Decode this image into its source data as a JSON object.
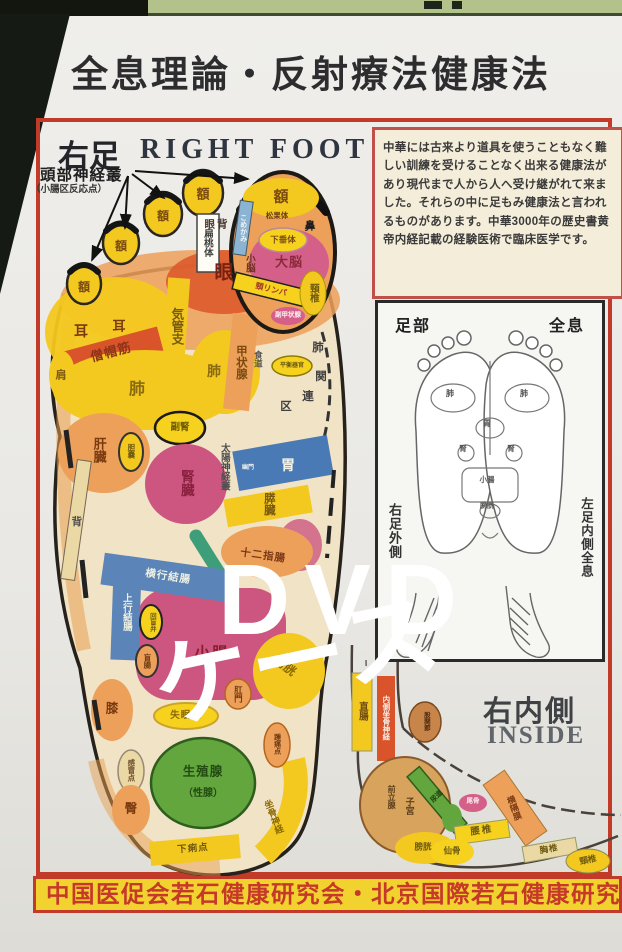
{
  "header": {
    "title": "全息理論・反射療法健康法"
  },
  "overlay": {
    "line1": "DVD",
    "line2": "ケース"
  },
  "foot_chart": {
    "title_jp": "右足",
    "title_en": "RIGHT FOOT",
    "annotation": "頭部神経叢",
    "annotation_sub": "（小腸区反応点）",
    "labels": [
      {
        "t": "額",
        "x": 84,
        "y": 287,
        "s": 12,
        "c": "#7a4a10"
      },
      {
        "t": "額",
        "x": 121,
        "y": 246,
        "s": 12,
        "c": "#7a4a10"
      },
      {
        "t": "額",
        "x": 163,
        "y": 216,
        "s": 12,
        "c": "#7a4a10"
      },
      {
        "t": "額",
        "x": 203,
        "y": 194,
        "s": 13,
        "c": "#7a4a10"
      },
      {
        "t": "額",
        "x": 281,
        "y": 197,
        "s": 15,
        "c": "#7a4a10"
      },
      {
        "t": "扁桃体",
        "x": 207,
        "y": 243,
        "s": 9.5,
        "c": "#3f3f3f",
        "v": 1
      },
      {
        "t": "眼背",
        "x": 217,
        "y": 225,
        "s": 10.5,
        "c": "#4a3a32",
        "ls": 2
      },
      {
        "t": "こめかみ",
        "x": 243,
        "y": 228,
        "s": 7,
        "c": "#f4f6f8",
        "v": 1
      },
      {
        "t": "松果体",
        "x": 277,
        "y": 216,
        "s": 7.5,
        "c": "#6b3a1a"
      },
      {
        "t": "下垂体",
        "x": 283,
        "y": 240,
        "s": 8.5,
        "c": "#7a4a10"
      },
      {
        "t": "大脳",
        "x": 289,
        "y": 262,
        "s": 13,
        "c": "#8a2a3a",
        "ls": 1
      },
      {
        "t": "小脳",
        "x": 249,
        "y": 263,
        "s": 9.5,
        "c": "#6e3020",
        "v": 1
      },
      {
        "t": "鼻",
        "x": 310,
        "y": 227,
        "s": 11,
        "c": "#1e1e1e"
      },
      {
        "t": "頸リンパ",
        "x": 271,
        "y": 290,
        "s": 8,
        "c": "#a03828",
        "r": 14
      },
      {
        "t": "頸椎",
        "x": 313,
        "y": 293,
        "s": 9.5,
        "c": "#6e5a10",
        "v": 1
      },
      {
        "t": "副甲状腺",
        "x": 288,
        "y": 316,
        "s": 6.5,
        "c": "#fdf2f2"
      },
      {
        "t": "眼",
        "x": 224,
        "y": 273,
        "s": 19,
        "c": "#7a2010"
      },
      {
        "t": "耳",
        "x": 81,
        "y": 331,
        "s": 14,
        "c": "#7a3a10"
      },
      {
        "t": "耳",
        "x": 119,
        "y": 326,
        "s": 13,
        "c": "#7a3a10"
      },
      {
        "t": "僧帽筋",
        "x": 111,
        "y": 352,
        "s": 13,
        "c": "#8f3418",
        "r": -15,
        "ls": 1
      },
      {
        "t": "気管支",
        "x": 176,
        "y": 326,
        "s": 12.5,
        "c": "#7a5a10",
        "v": 1
      },
      {
        "t": "肺",
        "x": 137,
        "y": 390,
        "s": 16,
        "c": "#8a6a10"
      },
      {
        "t": "肺",
        "x": 214,
        "y": 371,
        "s": 14,
        "c": "#8a6a10"
      },
      {
        "t": "甲状腺",
        "x": 240,
        "y": 362,
        "s": 11.5,
        "c": "#7a4a10",
        "v": 1
      },
      {
        "t": "食道",
        "x": 258,
        "y": 359,
        "s": 8.5,
        "c": "#555555",
        "v": 1
      },
      {
        "t": "平衡器官",
        "x": 292,
        "y": 366,
        "s": 6,
        "c": "#6e5a10"
      },
      {
        "t": "肺",
        "x": 318,
        "y": 349,
        "s": 11.5,
        "c": "#3f3f3f"
      },
      {
        "t": "関",
        "x": 321,
        "y": 378,
        "s": 11.5,
        "c": "#3f3f3f"
      },
      {
        "t": "連",
        "x": 308,
        "y": 398,
        "s": 11.5,
        "c": "#3f3f3f"
      },
      {
        "t": "区",
        "x": 286,
        "y": 408,
        "s": 11.5,
        "c": "#3f3f3f"
      },
      {
        "t": "肩",
        "x": 61,
        "y": 376,
        "s": 11,
        "c": "#7a5a10"
      },
      {
        "t": "肝臓",
        "x": 99,
        "y": 450,
        "s": 13,
        "c": "#7a3a10",
        "v": 1
      },
      {
        "t": "胆嚢",
        "x": 131,
        "y": 451,
        "s": 7.5,
        "c": "#6e5a10",
        "v": 1
      },
      {
        "t": "副腎",
        "x": 180,
        "y": 428,
        "s": 9.5,
        "c": "#6e5a00"
      },
      {
        "t": "腎臓",
        "x": 186,
        "y": 483,
        "s": 13.5,
        "c": "#8a2040",
        "v": 1
      },
      {
        "t": "太陽神経叢",
        "x": 224,
        "y": 467,
        "s": 9.5,
        "c": "#4f4f4f",
        "v": 1
      },
      {
        "t": "胃",
        "x": 288,
        "y": 465,
        "s": 14,
        "c": "#f2f2e6"
      },
      {
        "t": "幽門",
        "x": 248,
        "y": 468,
        "s": 6,
        "c": "#eeeeee"
      },
      {
        "t": "膵臓",
        "x": 268,
        "y": 504,
        "s": 11.5,
        "c": "#7a5a10",
        "v": 1
      },
      {
        "t": "十二指腸",
        "x": 263,
        "y": 556,
        "s": 10.5,
        "c": "#7a3a18",
        "r": 8,
        "ls": 1
      },
      {
        "t": "背",
        "x": 76,
        "y": 521,
        "s": 10.5,
        "c": "#4f4f4f",
        "v": 1
      },
      {
        "t": "横行結腸",
        "x": 168,
        "y": 577,
        "s": 10.5,
        "c": "#eef0e2",
        "r": 9,
        "ls": 1
      },
      {
        "t": "上行結腸",
        "x": 126,
        "y": 612,
        "s": 9.5,
        "c": "#eef0e2",
        "v": 1
      },
      {
        "t": "回盲弁",
        "x": 151,
        "y": 622,
        "s": 6.5,
        "c": "#6e5a10",
        "v": 1
      },
      {
        "t": "盲腸",
        "x": 147,
        "y": 661,
        "s": 7.5,
        "c": "#6e3a10",
        "v": 1
      },
      {
        "t": "小腸",
        "x": 212,
        "y": 654,
        "s": 15.5,
        "c": "#8a1f30",
        "ls": 2
      },
      {
        "t": "膀胱",
        "x": 285,
        "y": 666,
        "s": 12,
        "c": "#8a6a00",
        "r": 38
      },
      {
        "t": "肛門",
        "x": 238,
        "y": 694,
        "s": 8.5,
        "c": "#6e3a10",
        "v": 1
      },
      {
        "t": "失眠点",
        "x": 186,
        "y": 716,
        "s": 9.5,
        "c": "#8a6a00",
        "ls": 1
      },
      {
        "t": "生殖腺",
        "x": 203,
        "y": 772,
        "s": 12.5,
        "c": "#234a12",
        "ls": 1
      },
      {
        "t": "（性腺）",
        "x": 203,
        "y": 794,
        "s": 10,
        "c": "#234a12"
      },
      {
        "t": "感冒点",
        "x": 131,
        "y": 770,
        "s": 7.5,
        "c": "#6e4a2a",
        "v": 1
      },
      {
        "t": "膝",
        "x": 112,
        "y": 709,
        "s": 12.5,
        "c": "#7a3a10"
      },
      {
        "t": "臀",
        "x": 131,
        "y": 809,
        "s": 12.5,
        "c": "#7a3a10"
      },
      {
        "t": "下痢点",
        "x": 193,
        "y": 849,
        "s": 9.5,
        "c": "#6e5a10",
        "r": -5,
        "ls": 1
      },
      {
        "t": "坐骨神経",
        "x": 273,
        "y": 817,
        "s": 9,
        "c": "#8a6a00",
        "v": 1,
        "r": -22
      },
      {
        "t": "踵痛点",
        "x": 277,
        "y": 744,
        "s": 7,
        "c": "#6e3a10",
        "v": 1
      }
    ]
  },
  "info_box": {
    "text": "中華には古来より道具を使うこともなく難しい訓練を受けることなく出来る健康法があり現代まで人から人へ受け継がれて来ました。それらの中に足もみ健康法と言われるものがあります。中華3000年の歴史書黄帝内経記載の経験医術で臨床医学です。"
  },
  "inset": {
    "top_left": "足部",
    "top_right": "全息",
    "caption_left": "右足外側",
    "caption_right": "左足内側全息",
    "mini_labels": [
      {
        "t": "肺",
        "x": 450,
        "y": 394,
        "s": 8,
        "c": "#555555"
      },
      {
        "t": "肺",
        "x": 524,
        "y": 394,
        "s": 8,
        "c": "#555555"
      },
      {
        "t": "胃",
        "x": 487,
        "y": 424,
        "s": 8,
        "c": "#555555"
      },
      {
        "t": "腎",
        "x": 463,
        "y": 449,
        "s": 7.5,
        "c": "#555555"
      },
      {
        "t": "腎",
        "x": 511,
        "y": 449,
        "s": 7.5,
        "c": "#555555"
      },
      {
        "t": "小腸",
        "x": 487,
        "y": 480,
        "s": 7.5,
        "c": "#555555"
      },
      {
        "t": "膀胱",
        "x": 487,
        "y": 506,
        "s": 7,
        "c": "#555555"
      }
    ]
  },
  "inside_view": {
    "title_jp": "右内側",
    "title_en": "INSIDE",
    "labels": [
      {
        "t": "直腸",
        "x": 362,
        "y": 711,
        "s": 9.5,
        "c": "#6e4a10",
        "v": 1
      },
      {
        "t": "内側坐骨神経",
        "x": 386,
        "y": 718,
        "s": 7.5,
        "c": "#fbeee6",
        "v": 1
      },
      {
        "t": "股関節",
        "x": 425,
        "y": 721,
        "s": 6.5,
        "c": "#4a2a10",
        "v": 1
      },
      {
        "t": "前立腺",
        "x": 391,
        "y": 797,
        "s": 8,
        "c": "#5e401a",
        "v": 1
      },
      {
        "t": "子宮",
        "x": 409,
        "y": 806,
        "s": 9,
        "c": "#5e401a",
        "v": 1
      },
      {
        "t": "尿道",
        "x": 437,
        "y": 797,
        "s": 7,
        "c": "#1e3f12",
        "r": -44
      },
      {
        "t": "膀胱",
        "x": 423,
        "y": 847,
        "s": 8.5,
        "c": "#6e5a10"
      },
      {
        "t": "横隔膜",
        "x": 514,
        "y": 808,
        "s": 8.5,
        "c": "#7a3a10",
        "v": 1,
        "r": -20
      },
      {
        "t": "腰椎",
        "x": 482,
        "y": 831,
        "s": 9.5,
        "c": "#6e5a10",
        "r": -8,
        "ls": 2
      },
      {
        "t": "仙骨",
        "x": 452,
        "y": 851,
        "s": 8.5,
        "c": "#6e5a10"
      },
      {
        "t": "胸椎",
        "x": 549,
        "y": 849,
        "s": 8.5,
        "c": "#6e5a10",
        "r": -10,
        "ls": 1
      },
      {
        "t": "頸椎",
        "x": 588,
        "y": 860,
        "s": 8.5,
        "c": "#6e5a10",
        "r": -12
      },
      {
        "t": "尾骨",
        "x": 473,
        "y": 802,
        "s": 6.5,
        "c": "#fdf0f0"
      }
    ]
  },
  "footer": {
    "text": "中国医促会若石健康研究会・北京国際若石健康研究会認定"
  },
  "colors": {
    "paper": "#eceae6",
    "border_red": "#c23b28",
    "banner_bg": "#f2d22e",
    "banner_text": "#c5382a",
    "yellow": "#f3c81f",
    "yellow2": "#f6d21f",
    "orange": "#eda05a",
    "deep_orange": "#d9542b",
    "red_orange": "#dc5a2c",
    "pink": "#cc5680",
    "magenta": "#d4608a",
    "blue": "#4a7ab5",
    "blue2": "#5b84b8",
    "teal": "#3f9e7a",
    "green": "#63a63e",
    "light_blue": "#8ab4d2",
    "beige": "#ead9a4",
    "cream": "#f1e3c6",
    "strip_green": "#b3c28b"
  }
}
